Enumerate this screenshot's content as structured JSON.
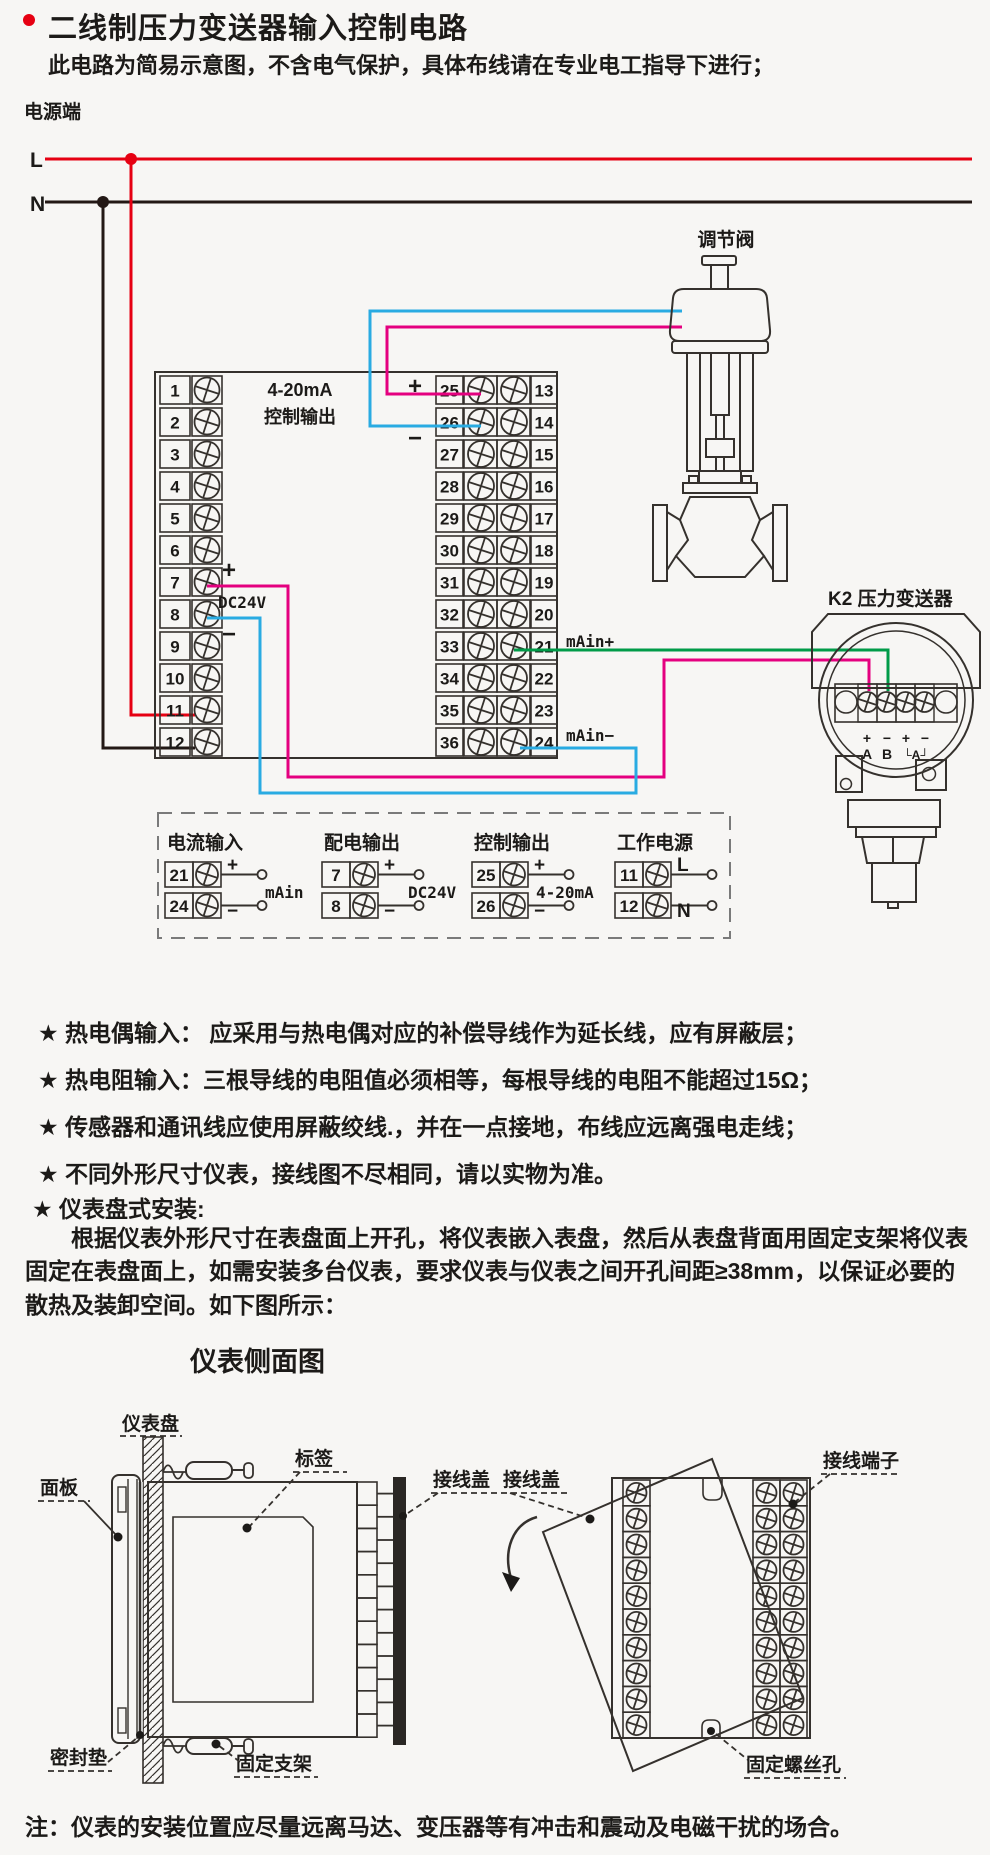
{
  "header": {
    "title": "二线制压力变送器输入控制电路",
    "subtitle": "此电路为简易示意图，不含电气保护，具体布线请在专业电工指导下进行；"
  },
  "circuit": {
    "power_label": "电源端",
    "live_label": "L",
    "neutral_label": "N",
    "block": {
      "left_numbers": [
        "1",
        "2",
        "3",
        "4",
        "5",
        "6",
        "7",
        "8",
        "9",
        "10",
        "11",
        "12"
      ],
      "mid_numbers": [
        "25",
        "26",
        "27",
        "28",
        "29",
        "30",
        "31",
        "32",
        "33",
        "34",
        "35",
        "36"
      ],
      "right_numbers": [
        "13",
        "14",
        "15",
        "16",
        "17",
        "18",
        "19",
        "20",
        "21",
        "22",
        "23",
        "24"
      ],
      "control_out_line1": "4-20mA",
      "control_out_line2": "控制输出",
      "ctrl_plus": "+",
      "ctrl_minus": "−",
      "dc_plus": "+",
      "dc_label": "DC24V",
      "dc_minus": "−",
      "main_plus": "mAin+",
      "main_minus": "mAin−"
    },
    "valve_label": "调节阀",
    "transmitter": {
      "label": "K2 压力变送器",
      "t1": "+",
      "t2": "−",
      "t3": "+",
      "t4": "−",
      "a": "A",
      "b": "B",
      "ab": "└A┘"
    },
    "legend": {
      "groups": [
        {
          "title": "电流输入",
          "rows": [
            {
              "num": "21",
              "sign": "+"
            },
            {
              "num": "24",
              "sign": "−"
            }
          ],
          "label": "mAin"
        },
        {
          "title": "配电输出",
          "rows": [
            {
              "num": "7",
              "sign": "+"
            },
            {
              "num": "8",
              "sign": "−"
            }
          ],
          "label": "DC24V"
        },
        {
          "title": "控制输出",
          "rows": [
            {
              "num": "25",
              "sign": "+"
            },
            {
              "num": "26",
              "sign": "−"
            }
          ],
          "label": "4-20mA"
        },
        {
          "title": "工作电源",
          "rows": [
            {
              "num": "11",
              "sign": "L"
            },
            {
              "num": "12",
              "sign": "N"
            }
          ],
          "label": ""
        }
      ]
    },
    "colors": {
      "live": "#e60012",
      "neutral": "#231815",
      "wire_plus": "#e4007f",
      "wire_minus": "#29abe2",
      "wire_loop": "#009b48"
    }
  },
  "notes": {
    "items": [
      "★ 热电偶输入： 应采用与热电偶对应的补偿导线作为延长线，应有屏蔽层；",
      "★ 热电阻输入：三根导线的电阻值必须相等，每根导线的电阻不能超过15Ω；",
      "★ 传感器和通讯线应使用屏蔽绞线.，并在一点接地，布线应远离强电走线；",
      "★ 不同外形尺寸仪表，接线图不尽相同，请以实物为准。",
      "★ 仪表盘式安装:"
    ],
    "install_paragraph": "根据仪表外形尺寸在表盘面上开孔，将仪表嵌入表盘，然后从表盘背面用固定支架将仪表固定在表盘面上，如需安装多台仪表，要求仪表与仪表之间开孔间距≥38mm，以保证必要的散热及装卸空间。如下图所示：",
    "side_view_title": "仪表侧面图"
  },
  "installation": {
    "panel_board": "仪表盘",
    "front_panel": "面板",
    "tag": "标签",
    "cover_left": "接线盖",
    "cover_right": "接线盖",
    "terminal_label": "接线端子",
    "seal": "密封垫",
    "bracket": "固定支架",
    "screw_hole": "固定螺丝孔"
  },
  "footer": {
    "note": "注：仪表的安装位置应尽量远离马达、变压器等有冲击和震动及电磁干扰的场合。"
  }
}
